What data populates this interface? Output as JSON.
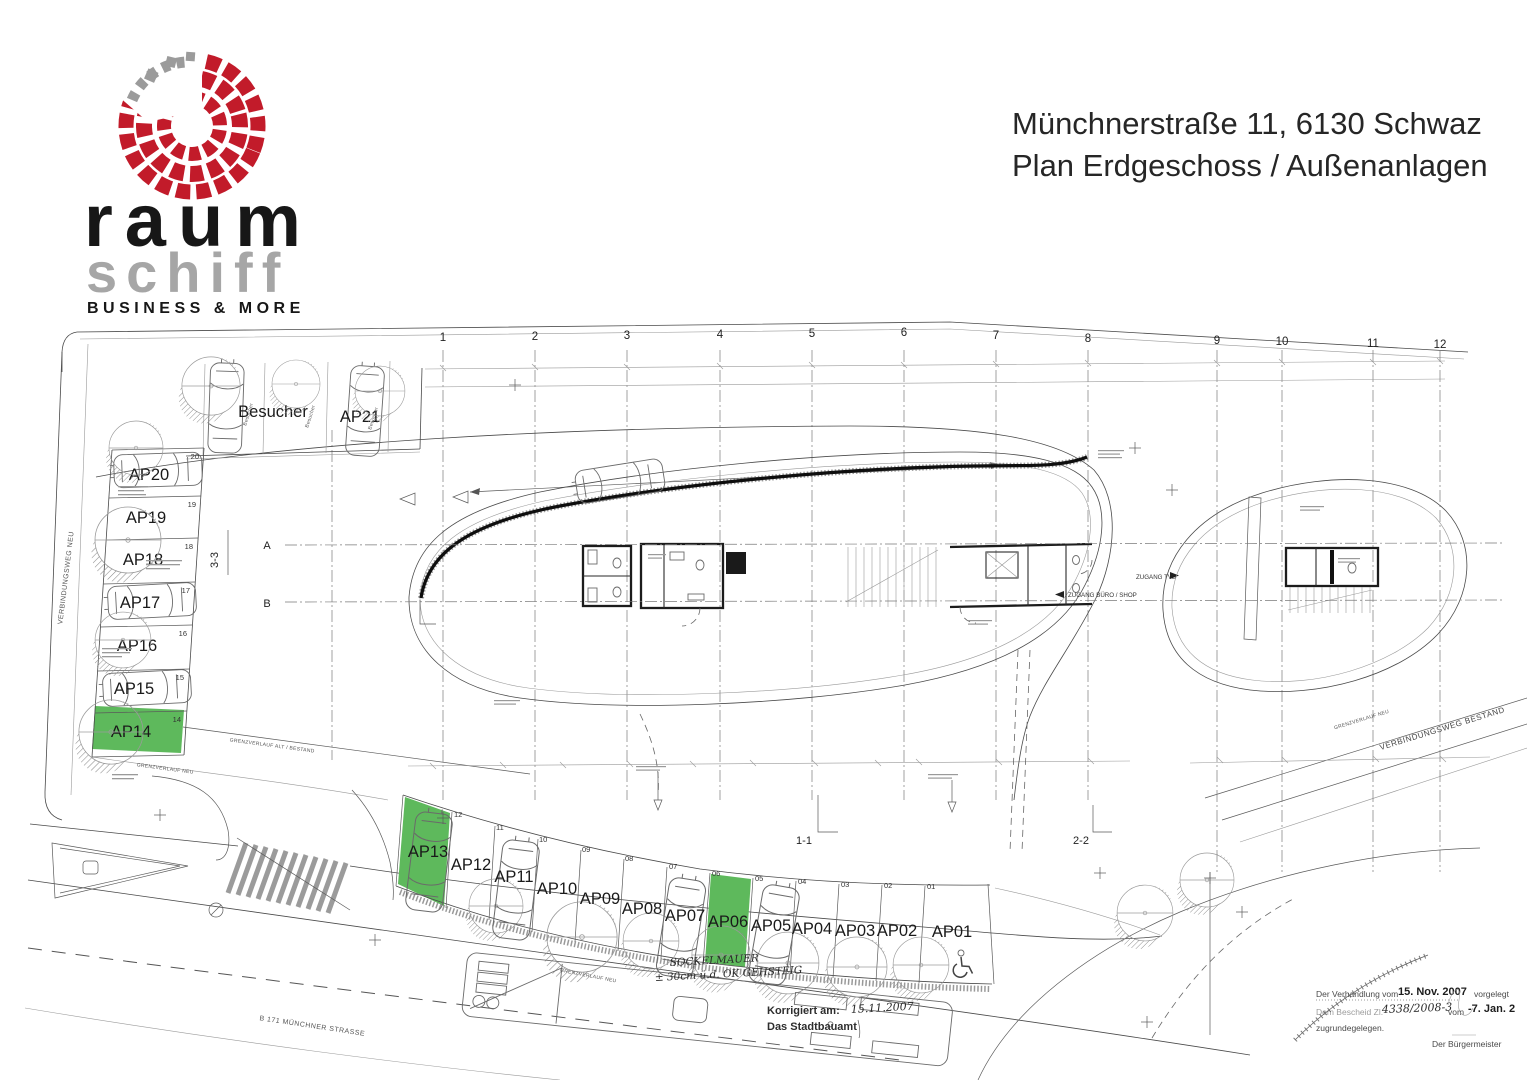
{
  "header": {
    "logo": {
      "word1": "raum",
      "word2": "schiff",
      "tagline": "BUSINESS & MORE"
    },
    "title_line1": "Münchnerstraße 11, 6130 Schwaz",
    "title_line2": "Plan Erdgeschoss / Außenanlagen"
  },
  "plan": {
    "grid_numbers": [
      "1",
      "2",
      "3",
      "4",
      "5",
      "6",
      "7",
      "8",
      "9",
      "10",
      "11",
      "12"
    ],
    "left_stalls": [
      {
        "label": "AP20",
        "num": "20"
      },
      {
        "label": "AP19",
        "num": "19"
      },
      {
        "label": "AP18",
        "num": "18"
      },
      {
        "label": "AP17",
        "num": "17"
      },
      {
        "label": "AP16",
        "num": "16"
      },
      {
        "label": "AP15",
        "num": "15"
      },
      {
        "label": "AP14",
        "num": "14"
      }
    ],
    "visitor_label": "Besucher",
    "ap21": "AP21",
    "bottom_stalls": [
      {
        "label": "AP13",
        "num": ""
      },
      {
        "label": "AP12",
        "num": "12"
      },
      {
        "label": "AP11",
        "num": "11"
      },
      {
        "label": "AP10",
        "num": "10"
      },
      {
        "label": "AP09",
        "num": "09"
      },
      {
        "label": "AP08",
        "num": "08"
      },
      {
        "label": "AP07",
        "num": "07"
      },
      {
        "label": "AP06",
        "num": "06"
      },
      {
        "label": "AP05",
        "num": "05"
      },
      {
        "label": "AP04",
        "num": "04"
      },
      {
        "label": "AP03",
        "num": "03"
      },
      {
        "label": "AP02",
        "num": "02"
      },
      {
        "label": "AP01",
        "num": "01"
      }
    ],
    "sections": {
      "s11": "1-1",
      "s22": "2-2",
      "s33": "3-3",
      "a": "A",
      "b": "B"
    },
    "labels": {
      "verbindungsweg_neu": "VERBINDUNGSWEG NEU",
      "verbindungsweg_bestand": "VERBINDUNGSWEG BESTAND",
      "grenzverlauf_alt": "GRENZVERLAUF ALT / BESTAND",
      "grenzverlauf_neu": "GRENZVERLAUF NEU",
      "b171": "B 171 MÜNCHNER STRASSE",
      "zugang_buero": "ZUGANG BÜRO / SHOP",
      "zugang_tvb": "ZUGANG TVB"
    },
    "handwritten": {
      "sockelmauer": "SOCKELMAUER",
      "sockelmauer_note": "± 30cm ü.d. OK GEHSTEIG",
      "korrigiert_label": "Korrigiert am:",
      "korrigiert_date": "15.11.2007",
      "stadtbauamt": "Das Stadtbauamt"
    },
    "stamp": {
      "line1_pre": "Der Verhandlung vom",
      "line1_date": "15. Nov. 2007",
      "line1_post": "vorgelegt",
      "line2_pre": "Dem Bescheid Zl.",
      "line2_num": "4338/2008-3",
      "line2_mid": "vom",
      "line2_date": "-7. Jan. 2",
      "line3": "zugrundegelegen.",
      "line4": "Der Bürgermeister"
    }
  },
  "colors": {
    "highlight": "#5eb95c",
    "logo_red": "#c21b2a",
    "logo_gray": "#9b9b9b"
  }
}
